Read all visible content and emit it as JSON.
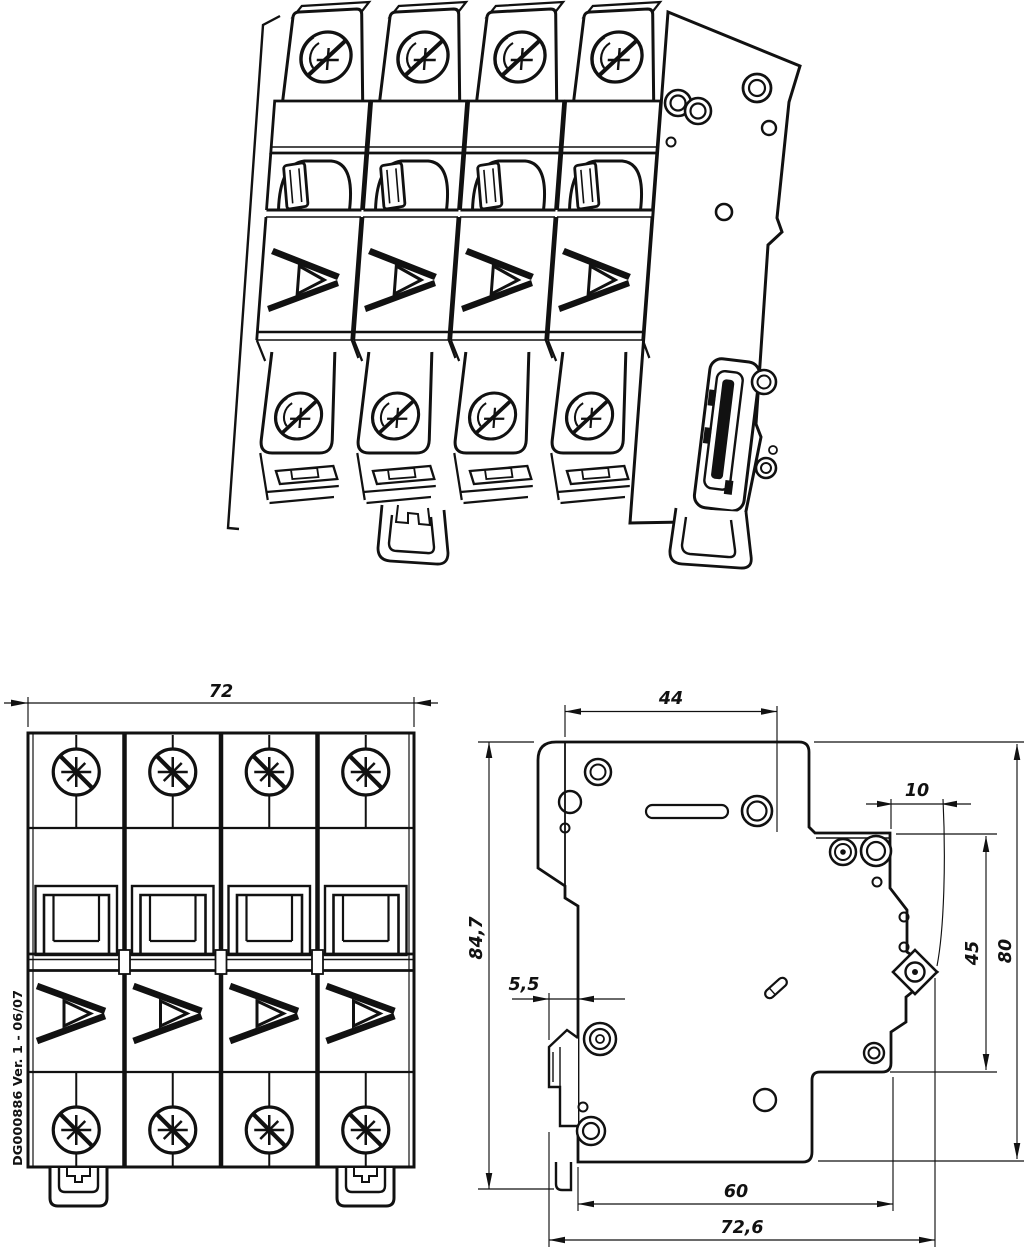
{
  "drawing": {
    "background": "#ffffff",
    "line_color": "#111111",
    "marking": "DG000886 Ver. 1 - 06/07",
    "pole_count": "4"
  },
  "dims": {
    "front_width": "72",
    "top_depth": "44",
    "terminal_depth": "10",
    "front_height": "84,7",
    "clip_protrusion": "5,5",
    "rear_section_height": "45",
    "rear_height": "80",
    "base_depth": "60",
    "total_depth": "72,6"
  }
}
